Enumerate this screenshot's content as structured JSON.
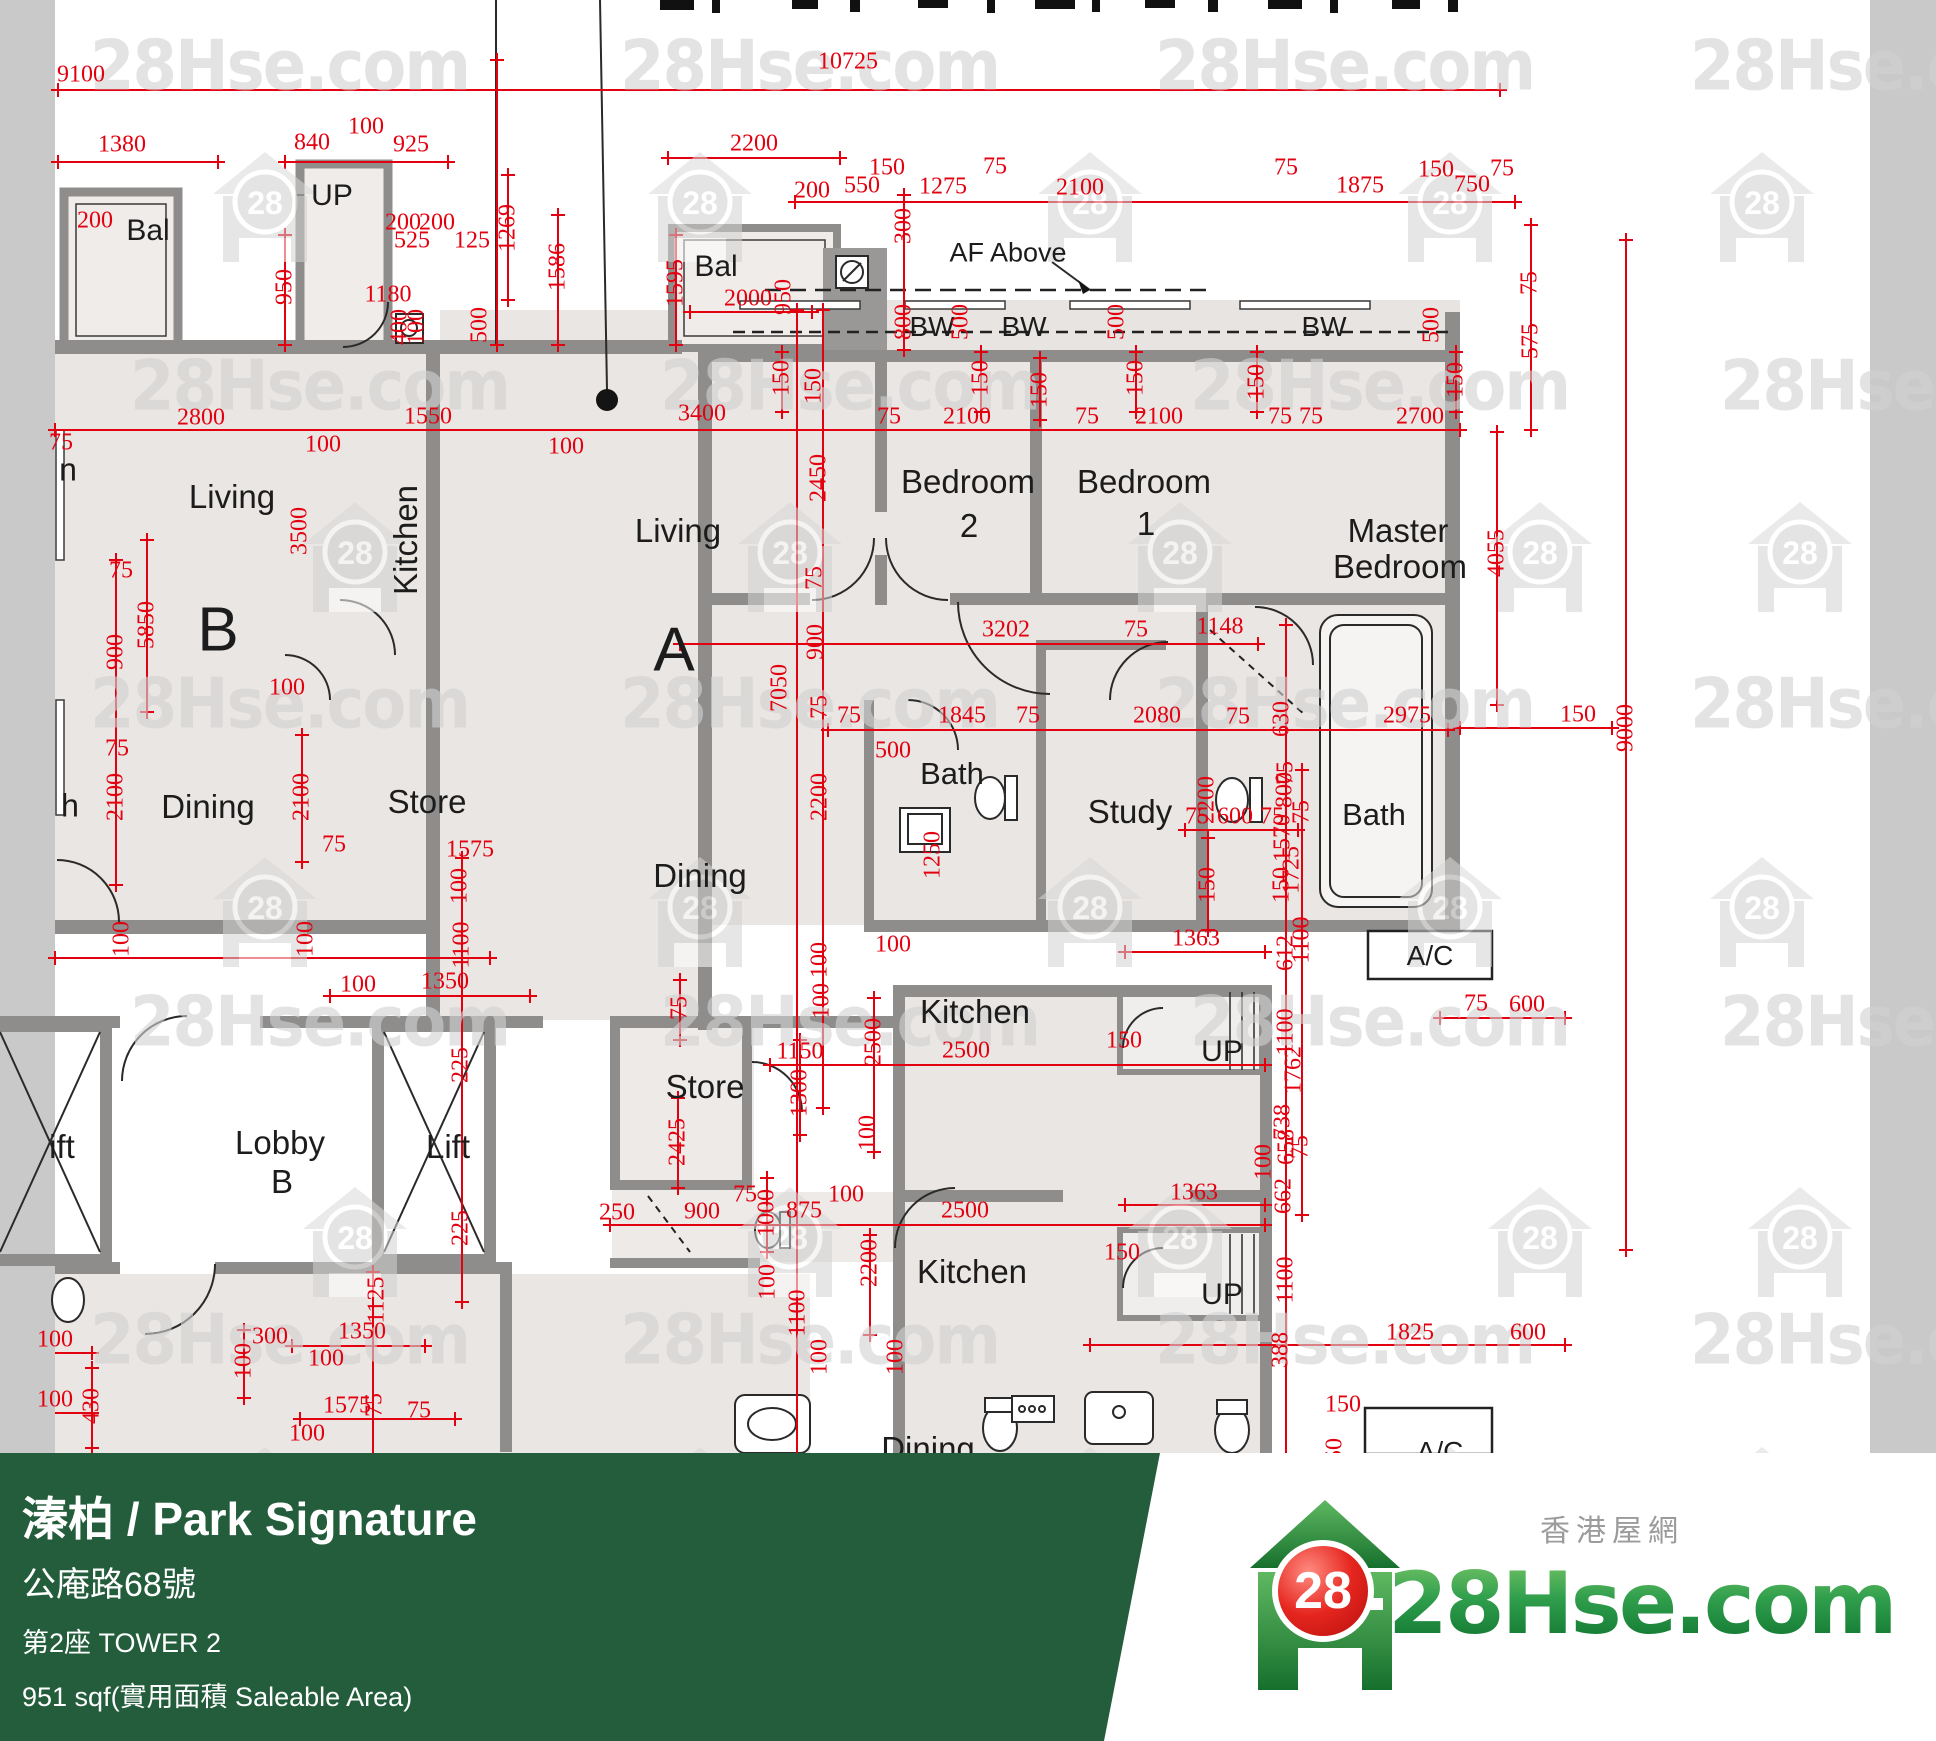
{
  "banner": {
    "title": "溱柏 / Park Signature",
    "address": "公庵路68號",
    "tower": "第2座   TOWER 2",
    "area": "951 sqf(實用面積 Saleable Area)",
    "bg_color": "#245D3C"
  },
  "logo": {
    "site": "28Hse.com",
    "badge": "28",
    "tagline": "香港屋網"
  },
  "watermarks": {
    "text": "28Hse.com",
    "badge": "28",
    "text_rows": [
      30,
      350,
      668,
      986,
      1304
    ],
    "text_cols_even": [
      90,
      620,
      1155,
      1690
    ],
    "text_cols_odd": [
      130,
      660,
      1190,
      1720
    ],
    "icon_rows": [
      150,
      500,
      855,
      1185,
      1445
    ],
    "icon_cols_even": [
      265,
      700,
      1090,
      1450,
      1762
    ],
    "icon_cols_odd": [
      355,
      790,
      1180,
      1540,
      1800
    ]
  },
  "plan": {
    "colors": {
      "dim_red": "#e3000f",
      "wall_gray": "#8f8d8b",
      "room_fill": "#eae6e3"
    },
    "room_labels": [
      [
        "Bal",
        148,
        231,
        30,
        0
      ],
      [
        "UP",
        332,
        196,
        30,
        0
      ],
      [
        "Bal",
        716,
        267,
        30,
        0
      ],
      [
        "AF Above",
        1008,
        253,
        27,
        0
      ],
      [
        "BW",
        932,
        327,
        28,
        0
      ],
      [
        "BW",
        1024,
        327,
        28,
        0
      ],
      [
        "BW",
        1324,
        327,
        28,
        0
      ],
      [
        "n",
        68,
        470,
        32,
        0
      ],
      [
        "Living",
        232,
        497,
        33,
        0
      ],
      [
        "Kitchen",
        406,
        540,
        33,
        1
      ],
      [
        "Living",
        678,
        531,
        33,
        0
      ],
      [
        "B",
        218,
        630,
        62,
        0
      ],
      [
        "A",
        674,
        650,
        62,
        0
      ],
      [
        "Bedroom",
        968,
        482,
        33,
        0
      ],
      [
        "2",
        969,
        526,
        33,
        0
      ],
      [
        "Bedroom",
        1144,
        482,
        33,
        0
      ],
      [
        "1",
        1146,
        524,
        33,
        0
      ],
      [
        "Master",
        1398,
        531,
        33,
        0
      ],
      [
        "Bedroom",
        1400,
        567,
        33,
        0
      ],
      [
        "Dining",
        208,
        807,
        33,
        0
      ],
      [
        "Store",
        427,
        802,
        33,
        0
      ],
      [
        "h",
        70,
        806,
        32,
        0
      ],
      [
        "Bath",
        952,
        774,
        31,
        0
      ],
      [
        "Study",
        1130,
        812,
        33,
        0
      ],
      [
        "Bath",
        1374,
        815,
        31,
        0
      ],
      [
        "A/C",
        1430,
        956,
        28,
        0
      ],
      [
        "Dining",
        700,
        876,
        33,
        0
      ],
      [
        "Lobby",
        280,
        1143,
        33,
        0
      ],
      [
        "B",
        282,
        1182,
        33,
        0
      ],
      [
        "ift",
        62,
        1147,
        33,
        0
      ],
      [
        "Lift",
        448,
        1147,
        33,
        0
      ],
      [
        "Store",
        705,
        1087,
        33,
        0
      ],
      [
        "Kitchen",
        975,
        1012,
        33,
        0
      ],
      [
        "Kitchen",
        972,
        1272,
        33,
        0
      ],
      [
        "UP",
        1222,
        1052,
        30,
        0
      ],
      [
        "UP",
        1222,
        1295,
        30,
        0
      ],
      [
        "A/C",
        1440,
        1452,
        28,
        0
      ],
      [
        "Dining",
        928,
        1449,
        33,
        0
      ]
    ],
    "dim_labels": [
      [
        "9100",
        81,
        75,
        0
      ],
      [
        "10725",
        848,
        62,
        0
      ],
      [
        "1380",
        122,
        145,
        0
      ],
      [
        "100",
        366,
        127,
        0
      ],
      [
        "840",
        312,
        143,
        0
      ],
      [
        "925",
        411,
        145,
        0
      ],
      [
        "200",
        95,
        221,
        0
      ],
      [
        "200",
        403,
        223,
        0
      ],
      [
        "200",
        437,
        223,
        0
      ],
      [
        "525",
        412,
        241,
        0
      ],
      [
        "125",
        472,
        241,
        0
      ],
      [
        "1180",
        388,
        295,
        0
      ],
      [
        "950",
        285,
        287,
        1
      ],
      [
        "1586",
        558,
        267,
        1
      ],
      [
        "1595",
        676,
        283,
        1
      ],
      [
        "1269",
        508,
        228,
        1
      ],
      [
        "400",
        400,
        327,
        1
      ],
      [
        "100",
        417,
        327,
        1
      ],
      [
        "500",
        480,
        325,
        1
      ],
      [
        "2200",
        754,
        144,
        0
      ],
      [
        "200",
        812,
        191,
        0
      ],
      [
        "550",
        862,
        186,
        0
      ],
      [
        "150",
        887,
        168,
        0
      ],
      [
        "1275",
        943,
        187,
        0
      ],
      [
        "75",
        995,
        167,
        0
      ],
      [
        "2100",
        1080,
        188,
        0
      ],
      [
        "300",
        904,
        226,
        1
      ],
      [
        "2000",
        748,
        299,
        0
      ],
      [
        "950",
        784,
        297,
        1
      ],
      [
        "75",
        1286,
        168,
        0
      ],
      [
        "1875",
        1360,
        186,
        0
      ],
      [
        "150",
        1436,
        170,
        0
      ],
      [
        "750",
        1472,
        185,
        0
      ],
      [
        "75",
        1502,
        169,
        0
      ],
      [
        "800",
        904,
        322,
        1
      ],
      [
        "500",
        961,
        322,
        1
      ],
      [
        "500",
        1117,
        322,
        1
      ],
      [
        "500",
        1432,
        325,
        1
      ],
      [
        "150",
        782,
        378,
        1
      ],
      [
        "150",
        981,
        378,
        1
      ],
      [
        "150",
        1136,
        378,
        1
      ],
      [
        "150",
        1257,
        382,
        1
      ],
      [
        "150",
        1456,
        380,
        1
      ],
      [
        "75",
        1530,
        283,
        1
      ],
      [
        "575",
        1531,
        341,
        1
      ],
      [
        "75",
        889,
        417,
        0
      ],
      [
        "2100",
        967,
        417,
        0
      ],
      [
        "75",
        1087,
        417,
        0
      ],
      [
        "2100",
        1159,
        417,
        0
      ],
      [
        "75",
        1280,
        417,
        0
      ],
      [
        "75",
        1311,
        417,
        0
      ],
      [
        "2700",
        1420,
        417,
        0
      ],
      [
        "150",
        1040,
        390,
        1
      ],
      [
        "2800",
        201,
        418,
        0
      ],
      [
        "1550",
        428,
        417,
        0
      ],
      [
        "100",
        323,
        445,
        0
      ],
      [
        "3400",
        702,
        414,
        0
      ],
      [
        "100",
        566,
        447,
        0
      ],
      [
        "150",
        814,
        386,
        1
      ],
      [
        "2450",
        819,
        478,
        1
      ],
      [
        "3500",
        300,
        531,
        1
      ],
      [
        "75",
        61,
        443,
        0
      ],
      [
        "5850",
        147,
        625,
        1
      ],
      [
        "75",
        121,
        571,
        0
      ],
      [
        "900",
        116,
        652,
        1
      ],
      [
        "75",
        117,
        749,
        0
      ],
      [
        "2100",
        116,
        797,
        1
      ],
      [
        "100",
        287,
        688,
        0
      ],
      [
        "2100",
        302,
        797,
        1
      ],
      [
        "4055",
        1497,
        553,
        1
      ],
      [
        "9000",
        1626,
        728,
        1
      ],
      [
        "150",
        1578,
        715,
        0
      ],
      [
        "3202",
        1006,
        630,
        0
      ],
      [
        "75",
        1136,
        630,
        0
      ],
      [
        "1148",
        1220,
        627,
        0
      ],
      [
        "75",
        815,
        578,
        1
      ],
      [
        "900",
        816,
        642,
        1
      ],
      [
        "7050",
        780,
        688,
        1
      ],
      [
        "75",
        820,
        707,
        1
      ],
      [
        "75",
        849,
        716,
        0
      ],
      [
        "1845",
        962,
        716,
        0
      ],
      [
        "75",
        1028,
        716,
        0
      ],
      [
        "500",
        893,
        751,
        0
      ],
      [
        "2080",
        1157,
        716,
        0
      ],
      [
        "75",
        1238,
        717,
        0
      ],
      [
        "630",
        1282,
        719,
        1
      ],
      [
        "2975",
        1407,
        716,
        0
      ],
      [
        "2200",
        820,
        797,
        1
      ],
      [
        "1250",
        933,
        855,
        1
      ],
      [
        "100",
        893,
        945,
        0
      ],
      [
        "100",
        820,
        960,
        1
      ],
      [
        "2200",
        1207,
        800,
        1
      ],
      [
        "75",
        1286,
        773,
        1
      ],
      [
        "1570",
        1283,
        838,
        1
      ],
      [
        "150",
        1208,
        885,
        1
      ],
      [
        "150",
        1282,
        885,
        1
      ],
      [
        "1363",
        1196,
        939,
        0
      ],
      [
        "612",
        1286,
        953,
        1
      ],
      [
        "800",
        1285,
        790,
        1
      ],
      [
        "75",
        1302,
        812,
        1
      ],
      [
        "75",
        1197,
        817,
        0
      ],
      [
        "600",
        1235,
        817,
        0
      ],
      [
        "75",
        1272,
        817,
        0
      ],
      [
        "1725",
        1292,
        870,
        1
      ],
      [
        "1100",
        1302,
        940,
        1
      ],
      [
        "1762",
        1294,
        1070,
        1
      ],
      [
        "658",
        1287,
        1147,
        1
      ],
      [
        "75",
        1301,
        1147,
        1
      ],
      [
        "1575",
        470,
        850,
        0
      ],
      [
        "75",
        334,
        845,
        0
      ],
      [
        "100",
        122,
        939,
        1
      ],
      [
        "100",
        306,
        939,
        1
      ],
      [
        "100",
        460,
        886,
        1
      ],
      [
        "1100",
        462,
        945,
        1
      ],
      [
        "100",
        358,
        985,
        0
      ],
      [
        "1350",
        445,
        982,
        0
      ],
      [
        "225",
        461,
        1065,
        1
      ],
      [
        "225",
        461,
        1228,
        1
      ],
      [
        "250",
        617,
        1213,
        0
      ],
      [
        "1125",
        377,
        1300,
        1
      ],
      [
        "75",
        680,
        1008,
        1
      ],
      [
        "2425",
        678,
        1142,
        1
      ],
      [
        "1150",
        800,
        1052,
        0
      ],
      [
        "1300",
        800,
        1093,
        1
      ],
      [
        "100",
        822,
        1001,
        1
      ],
      [
        "2500",
        874,
        1042,
        1
      ],
      [
        "2500",
        966,
        1051,
        0
      ],
      [
        "100",
        868,
        1133,
        1
      ],
      [
        "900",
        702,
        1212,
        0
      ],
      [
        "75",
        745,
        1195,
        0
      ],
      [
        "1000",
        767,
        1213,
        1
      ],
      [
        "875",
        804,
        1211,
        0
      ],
      [
        "100",
        846,
        1195,
        0
      ],
      [
        "2500",
        965,
        1211,
        0
      ],
      [
        "2200",
        870,
        1263,
        1
      ],
      [
        "100",
        768,
        1282,
        1
      ],
      [
        "1100",
        798,
        1313,
        1
      ],
      [
        "100",
        820,
        1357,
        1
      ],
      [
        "100",
        896,
        1357,
        1
      ],
      [
        "150",
        1124,
        1041,
        0
      ],
      [
        "1100",
        1286,
        1032,
        1
      ],
      [
        "738",
        1283,
        1122,
        1
      ],
      [
        "100",
        1264,
        1162,
        1
      ],
      [
        "662",
        1284,
        1196,
        1
      ],
      [
        "1363",
        1194,
        1193,
        0
      ],
      [
        "150",
        1122,
        1253,
        0
      ],
      [
        "1100",
        1286,
        1280,
        1
      ],
      [
        "388",
        1281,
        1350,
        1
      ],
      [
        "1825",
        1410,
        1333,
        0
      ],
      [
        "600",
        1528,
        1333,
        0
      ],
      [
        "75",
        1476,
        1004,
        0
      ],
      [
        "600",
        1527,
        1005,
        0
      ],
      [
        "150",
        1343,
        1405,
        0
      ],
      [
        "50",
        1335,
        1450,
        1
      ],
      [
        "100",
        55,
        1340,
        0
      ],
      [
        "430",
        92,
        1406,
        1
      ],
      [
        "100",
        55,
        1400,
        0
      ],
      [
        "300",
        270,
        1337,
        0
      ],
      [
        "100",
        244,
        1361,
        1
      ],
      [
        "100",
        326,
        1359,
        0
      ],
      [
        "1350",
        362,
        1332,
        0
      ],
      [
        "1575",
        347,
        1406,
        0
      ],
      [
        "75",
        375,
        1405,
        1
      ],
      [
        "75",
        419,
        1411,
        0
      ],
      [
        "100",
        307,
        1434,
        0
      ]
    ]
  }
}
